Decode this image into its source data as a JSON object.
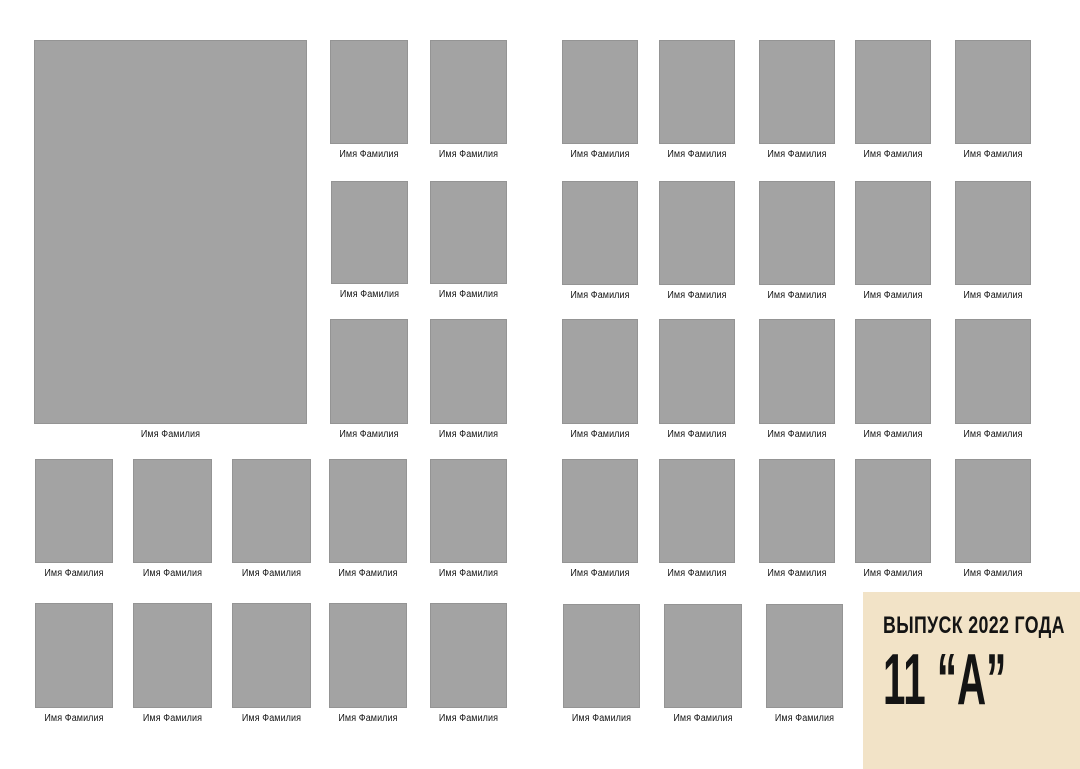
{
  "canvas": {
    "width": 1080,
    "height": 769
  },
  "colors": {
    "page_background": "#ffffff",
    "photo_placeholder": "#a3a3a3",
    "photo_border": "#949494",
    "label_block_bg": "#f2e3c7",
    "text_color": "#141414"
  },
  "label_block": {
    "title_line": "ВЫПУСК 2022 ГОДА",
    "class_line": "11 “А”"
  },
  "caption_default": "Имя Фамилия",
  "photos": [
    {
      "x": 34,
      "y": 40,
      "w": 273,
      "h": 384,
      "caption": "Имя Фамилия"
    },
    {
      "x": 330,
      "y": 40,
      "w": 78,
      "h": 104,
      "caption": "Имя Фамилия"
    },
    {
      "x": 430,
      "y": 40,
      "w": 77,
      "h": 104,
      "caption": "Имя Фамилия"
    },
    {
      "x": 331,
      "y": 181,
      "w": 77,
      "h": 103,
      "caption": "Имя Фамилия"
    },
    {
      "x": 430,
      "y": 181,
      "w": 77,
      "h": 103,
      "caption": "Имя Фамилия"
    },
    {
      "x": 330,
      "y": 319,
      "w": 78,
      "h": 105,
      "caption": "Имя Фамилия"
    },
    {
      "x": 430,
      "y": 319,
      "w": 77,
      "h": 105,
      "caption": "Имя Фамилия"
    },
    {
      "x": 35,
      "y": 459,
      "w": 78,
      "h": 104,
      "caption": "Имя Фамилия"
    },
    {
      "x": 133,
      "y": 459,
      "w": 79,
      "h": 104,
      "caption": "Имя Фамилия"
    },
    {
      "x": 232,
      "y": 459,
      "w": 79,
      "h": 104,
      "caption": "Имя Фамилия"
    },
    {
      "x": 329,
      "y": 459,
      "w": 78,
      "h": 104,
      "caption": "Имя Фамилия"
    },
    {
      "x": 430,
      "y": 459,
      "w": 77,
      "h": 104,
      "caption": "Имя Фамилия"
    },
    {
      "x": 35,
      "y": 603,
      "w": 78,
      "h": 105,
      "caption": "Имя Фамилия"
    },
    {
      "x": 133,
      "y": 603,
      "w": 79,
      "h": 105,
      "caption": "Имя Фамилия"
    },
    {
      "x": 232,
      "y": 603,
      "w": 79,
      "h": 105,
      "caption": "Имя Фамилия"
    },
    {
      "x": 329,
      "y": 603,
      "w": 78,
      "h": 105,
      "caption": "Имя Фамилия"
    },
    {
      "x": 430,
      "y": 603,
      "w": 77,
      "h": 105,
      "caption": "Имя Фамилия"
    },
    {
      "x": 562,
      "y": 40,
      "w": 76,
      "h": 104,
      "caption": "Имя Фамилия"
    },
    {
      "x": 659,
      "y": 40,
      "w": 76,
      "h": 104,
      "caption": "Имя Фамилия"
    },
    {
      "x": 759,
      "y": 40,
      "w": 76,
      "h": 104,
      "caption": "Имя Фамилия"
    },
    {
      "x": 855,
      "y": 40,
      "w": 76,
      "h": 104,
      "caption": "Имя Фамилия"
    },
    {
      "x": 955,
      "y": 40,
      "w": 76,
      "h": 104,
      "caption": "Имя Фамилия"
    },
    {
      "x": 562,
      "y": 181,
      "w": 76,
      "h": 104,
      "caption": "Имя Фамилия"
    },
    {
      "x": 659,
      "y": 181,
      "w": 76,
      "h": 104,
      "caption": "Имя Фамилия"
    },
    {
      "x": 759,
      "y": 181,
      "w": 76,
      "h": 104,
      "caption": "Имя Фамилия"
    },
    {
      "x": 855,
      "y": 181,
      "w": 76,
      "h": 104,
      "caption": "Имя Фамилия"
    },
    {
      "x": 955,
      "y": 181,
      "w": 76,
      "h": 104,
      "caption": "Имя Фамилия"
    },
    {
      "x": 562,
      "y": 319,
      "w": 76,
      "h": 105,
      "caption": "Имя Фамилия"
    },
    {
      "x": 659,
      "y": 319,
      "w": 76,
      "h": 105,
      "caption": "Имя Фамилия"
    },
    {
      "x": 759,
      "y": 319,
      "w": 76,
      "h": 105,
      "caption": "Имя Фамилия"
    },
    {
      "x": 855,
      "y": 319,
      "w": 76,
      "h": 105,
      "caption": "Имя Фамилия"
    },
    {
      "x": 955,
      "y": 319,
      "w": 76,
      "h": 105,
      "caption": "Имя Фамилия"
    },
    {
      "x": 562,
      "y": 459,
      "w": 76,
      "h": 104,
      "caption": "Имя Фамилия"
    },
    {
      "x": 659,
      "y": 459,
      "w": 76,
      "h": 104,
      "caption": "Имя Фамилия"
    },
    {
      "x": 759,
      "y": 459,
      "w": 76,
      "h": 104,
      "caption": "Имя Фамилия"
    },
    {
      "x": 855,
      "y": 459,
      "w": 76,
      "h": 104,
      "caption": "Имя Фамилия"
    },
    {
      "x": 955,
      "y": 459,
      "w": 76,
      "h": 104,
      "caption": "Имя Фамилия"
    },
    {
      "x": 563,
      "y": 604,
      "w": 77,
      "h": 104,
      "caption": "Имя Фамилия"
    },
    {
      "x": 664,
      "y": 604,
      "w": 78,
      "h": 104,
      "caption": "Имя Фамилия"
    },
    {
      "x": 766,
      "y": 604,
      "w": 77,
      "h": 104,
      "caption": "Имя Фамилия"
    }
  ]
}
